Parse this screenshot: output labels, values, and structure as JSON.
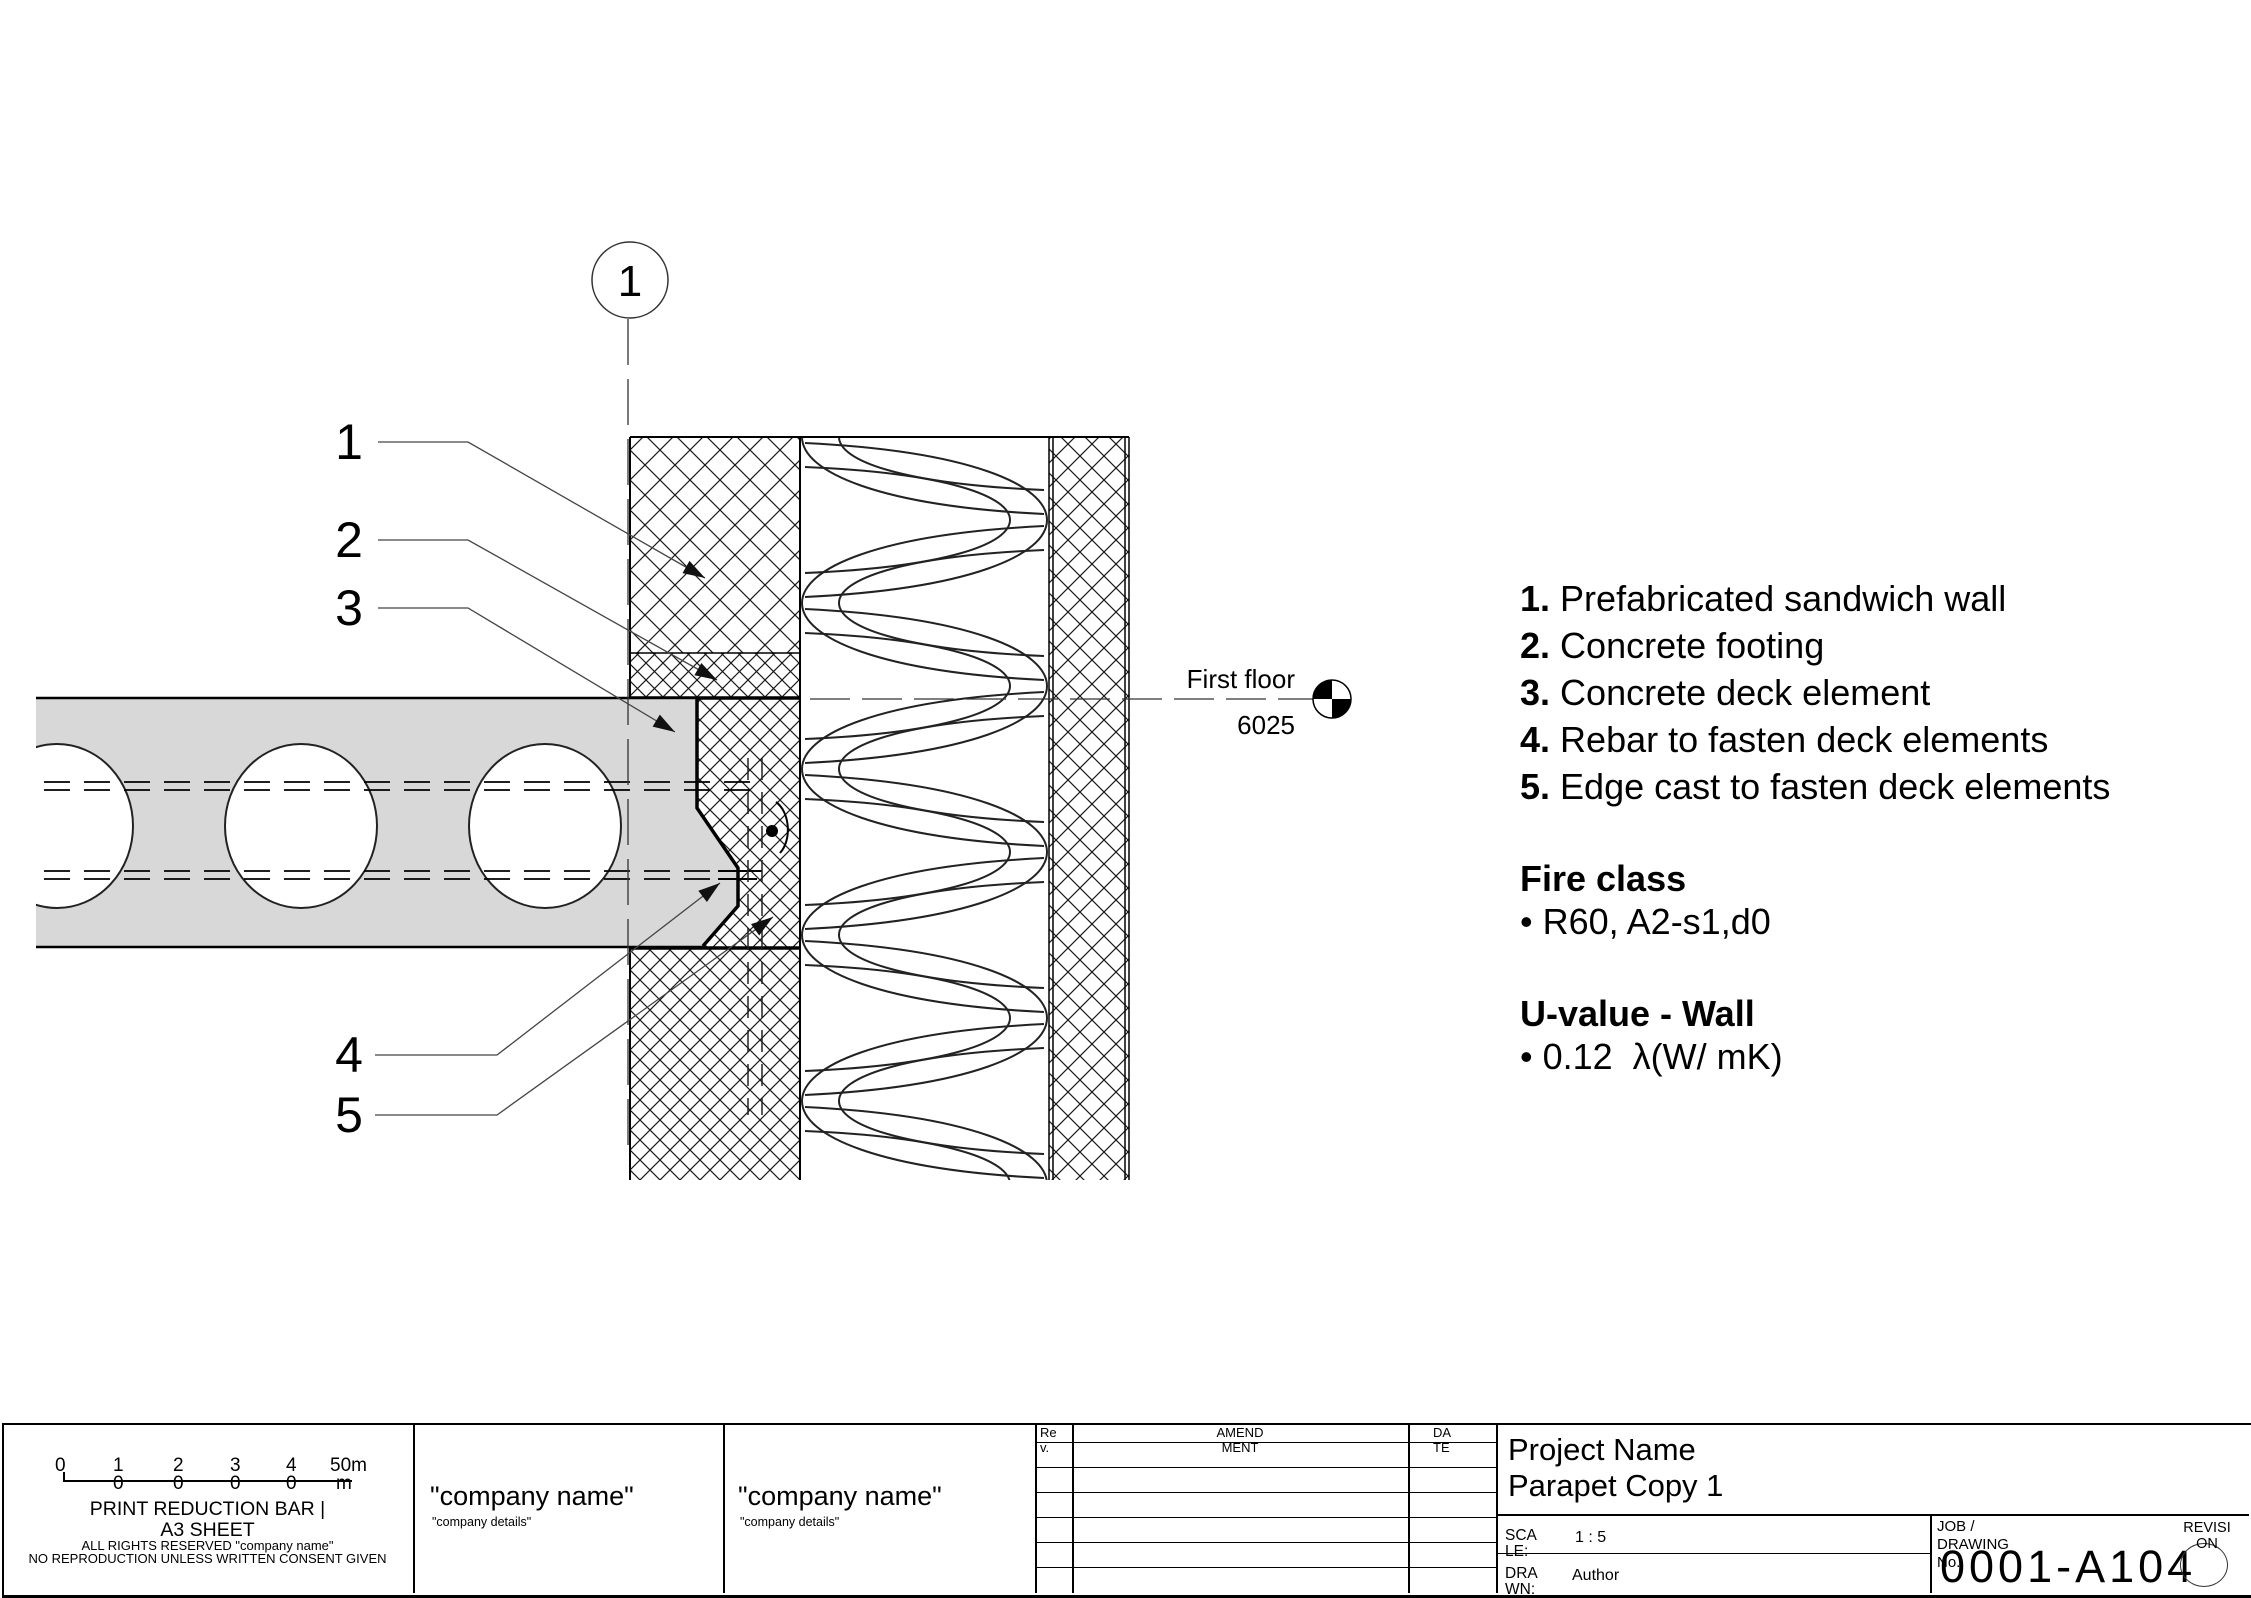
{
  "drawing": {
    "callout_number": "1",
    "part_labels": [
      "1",
      "2",
      "3",
      "4",
      "5"
    ],
    "level": {
      "name": "First floor",
      "elevation": "6025"
    },
    "legend_items": [
      {
        "num": "1.",
        "text": "Prefabricated sandwich wall"
      },
      {
        "num": "2.",
        "text": "Concrete footing"
      },
      {
        "num": "3.",
        "text": "Concrete deck element"
      },
      {
        "num": "4.",
        "text": "Rebar to fasten deck elements"
      },
      {
        "num": "5.",
        "text": "Edge cast to fasten deck elements"
      }
    ],
    "fire_class_heading": "Fire class",
    "fire_class_value": "• R60, A2-s1,d0",
    "u_value_heading": "U-value - Wall",
    "u_value_value": "• 0.12  λ(W/ mK)"
  },
  "title_block": {
    "scale_bar": {
      "top_labels": [
        "0",
        "1",
        "2",
        "3",
        "4",
        "50m"
      ],
      "bottom_labels": [
        "0",
        "0",
        "0",
        "0",
        "m"
      ],
      "caption1": "PRINT REDUCTION BAR |",
      "caption2": "A3 SHEET",
      "caption3": "ALL RIGHTS RESERVED \"company name\"",
      "caption4": "NO REPRODUCTION UNLESS WRITTEN CONSENT GIVEN"
    },
    "company1": {
      "name": "\"company name\"",
      "details": "\"company details\""
    },
    "company2": {
      "name": "\"company name\"",
      "details": "\"company details\""
    },
    "amendment": {
      "rev": "Rev.",
      "amendment": "AMENDMENT",
      "date": "DATE"
    },
    "project": {
      "name": "Project Name",
      "title": "Parapet Copy 1",
      "scale_label": "SCALE:",
      "scale_value": "1 : 5",
      "drawn_label": "DRAWN:",
      "drawn_value": "Author",
      "job_label": "JOB / DRAWING No.",
      "drawing_no": "0001-A104",
      "revision_label": "REVISION"
    }
  }
}
